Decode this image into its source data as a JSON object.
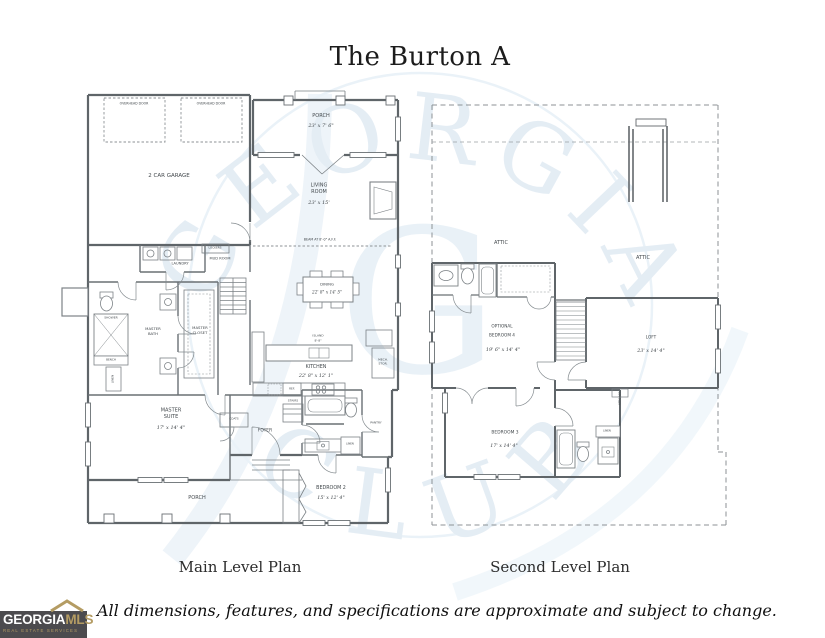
{
  "title": "The Burton A",
  "captions": {
    "main": "Main Level Plan",
    "second": "Second Level Plan"
  },
  "disclaimer": "All dimensions, features, and specifications are approximate and subject to change.",
  "logo": {
    "name_primary": "GEORGIA",
    "name_accent": "MLS",
    "tagline": "REAL ESTATE SERVICES"
  },
  "watermark": {
    "arc_top": "GEORGIA",
    "arc_bottom": "CLUB",
    "monogram": "G"
  },
  "colors": {
    "logo_bg": "#4c4b4e",
    "logo_gold": "#b49c63",
    "wall_gray": "#5f6569",
    "watermark_blue": "#dfe9f2"
  },
  "main_level": {
    "overhead_door_left": "OVERHEAD DOOR",
    "overhead_door_right": "OVERHEAD DOOR",
    "garage": "2 CAR GARAGE",
    "porch_top": {
      "name": "PORCH",
      "dims": "23' x 7' 6\""
    },
    "living_room": {
      "name": "LIVING ROOM",
      "dims": "23' x 15'"
    },
    "beam_note": "BEAM AT 8'-0\" A.F.F.",
    "lockers": "LOCKERS",
    "laundry": "LAUNDRY",
    "mud_room": "MUD ROOM",
    "dining": {
      "name": "DINING",
      "dims": "22' 8\" x 14' 5\""
    },
    "island": {
      "name": "ISLAND",
      "dims": "8'-8\""
    },
    "kitchen": {
      "name": "KITCHEN",
      "dims": "22' 8\" x 12' 1\""
    },
    "refrigerator": "REF.",
    "mech_storage": "MECH. STOR.",
    "shower": "SHOWER",
    "bench": "BENCH",
    "linen_master": "LINEN",
    "master_bath": "MASTER BATH",
    "master_closet": "MASTER CLOSET",
    "stairs": "STAIRS",
    "master_suite": {
      "name": "MASTER SUITE",
      "dims": "17' x 14' 4\""
    },
    "coats": "COATS",
    "foyer": "FOYER",
    "pantry": "PANTRY",
    "linen_hall": "LINEN",
    "porch_bottom": "PORCH",
    "bedroom2": {
      "name": "BEDROOM 2",
      "dims": "15' x 12' 4\""
    }
  },
  "second_level": {
    "attic_left": "ATTIC",
    "attic_right": "ATTIC",
    "bedroom4": {
      "line1": "OPTIONAL",
      "line2": "BEDROOM 4",
      "dims": "19' 6\" x 14' 4\""
    },
    "loft": {
      "name": "LOFT",
      "dims": "23' x 14' 4\""
    },
    "bedroom3": {
      "name": "BEDROOM 3",
      "dims": "17' x 14' 4\""
    },
    "linen": "LINEN",
    "attic_access": "ATTIC ACC."
  }
}
